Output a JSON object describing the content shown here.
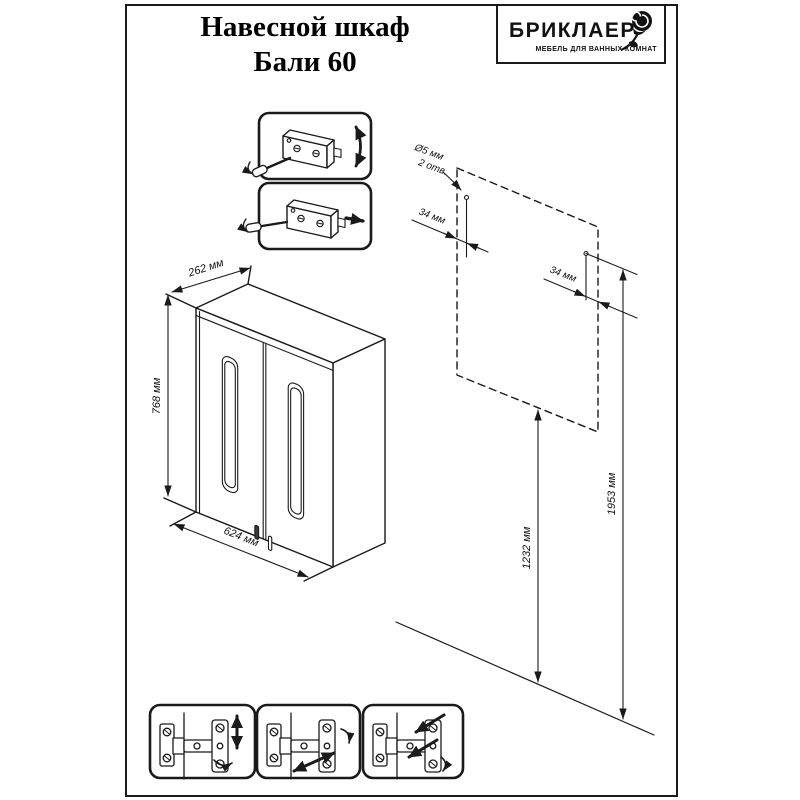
{
  "title": {
    "line1": "Навесной шкаф",
    "line2": "Бали 60"
  },
  "logo": {
    "brand": "БРИКЛАЕР",
    "tagline": "МЕБЕЛЬ ДЛЯ ВАННЫХ КОМНАТ"
  },
  "cabinet_dimensions": {
    "depth": "262 мм",
    "height": "768 мм",
    "width": "624 мм"
  },
  "mounting": {
    "hole_diameter": "Ø5 мм",
    "hole_count": "2 отв.",
    "offset_left": "34 мм",
    "offset_right": "34 мм",
    "height_to_bottom": "1232 мм",
    "height_to_holes": "1953 мм"
  },
  "colors": {
    "line": "#1a1a1a",
    "background": "#ffffff"
  }
}
